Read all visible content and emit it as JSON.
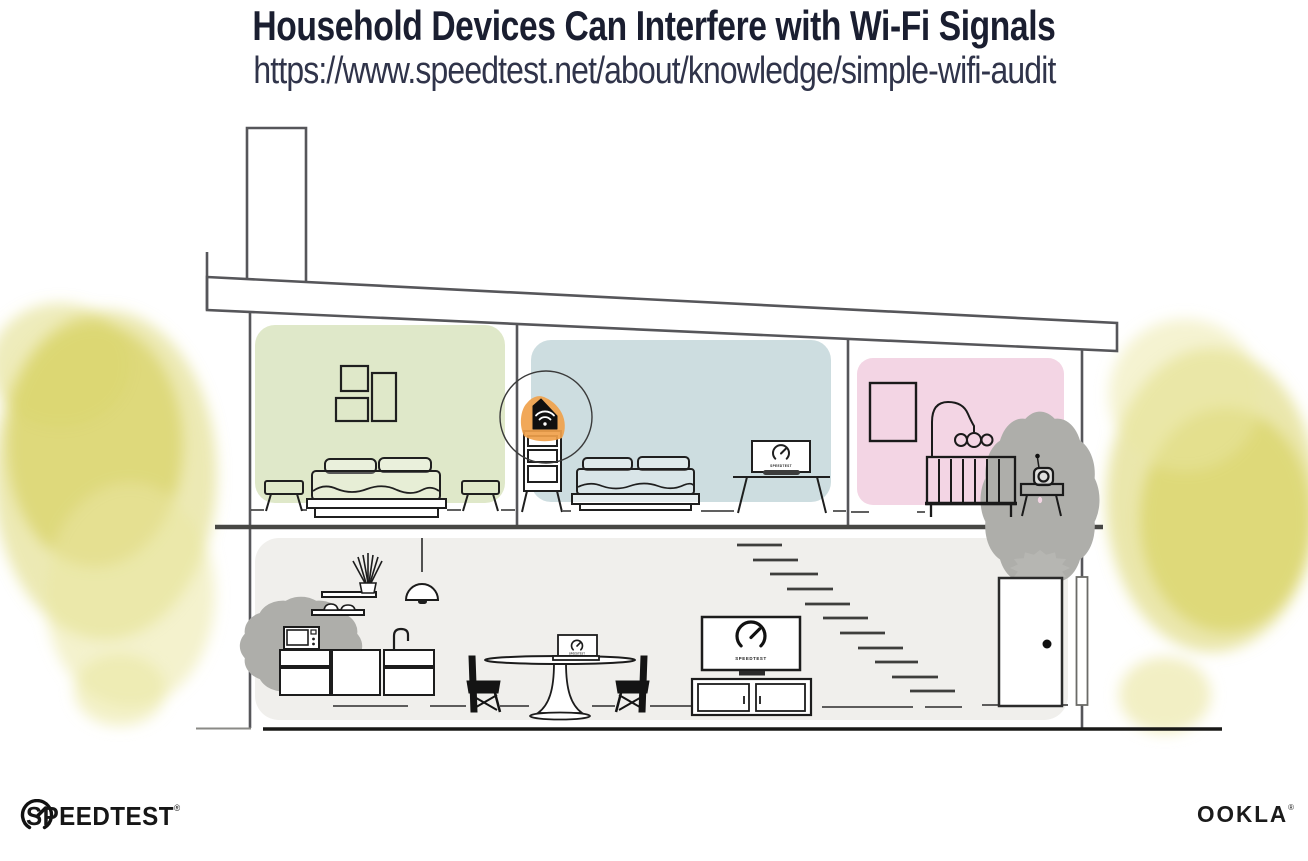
{
  "header": {
    "title": "Household Devices Can Interfere with Wi-Fi Signals",
    "url": "https://www.speedtest.net/about/knowledge/simple-wifi-audit"
  },
  "footer": {
    "speedtest_logo_text": "SPEEDTEST",
    "speedtest_trademark": "®",
    "ookla_logo_text": "OOKLA",
    "ookla_trademark": "®"
  },
  "illustration": {
    "device_screen_labels": {
      "bedroom_laptop": "SPEEDTEST",
      "living_room_tv": "SPEEDTEST",
      "dining_laptop": "SPEEDTEST"
    },
    "highlighted_device": "wifi-router-on-dresser",
    "interference_sources": [
      "microwave-oven",
      "baby-monitor"
    ],
    "rooms": [
      "green-bedroom",
      "blue-bedroom",
      "pink-nursery",
      "main-floor-living-area"
    ],
    "colors": {
      "green_bedroom_wall": "#dfe8c9",
      "blue_bedroom_wall": "#cddde0",
      "pink_nursery_wall": "#f3d5e4",
      "main_floor_wall": "#f0efec",
      "router_highlight_orange": "#f0a14b",
      "foliage_yellow": "#d9d468",
      "title_navy": "#1a1e30"
    }
  }
}
